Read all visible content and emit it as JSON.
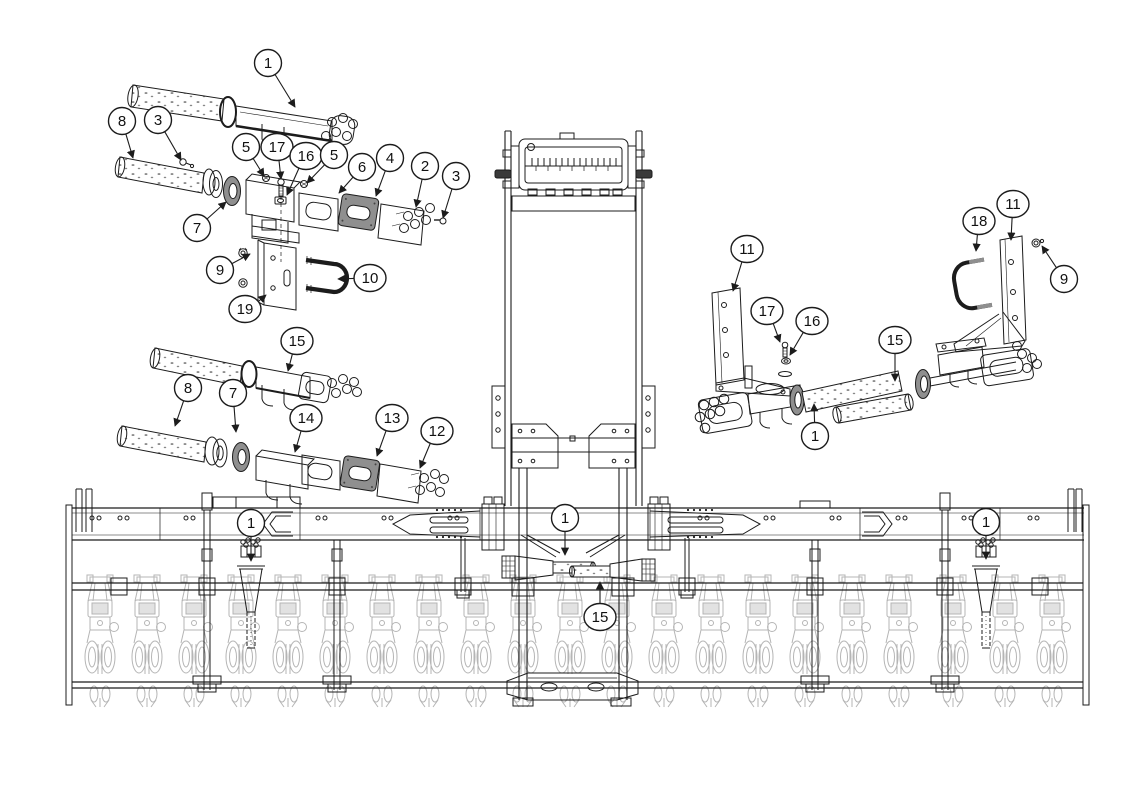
{
  "figure": {
    "type": "exploded-parts-diagram",
    "subject": "planter toolbar with center frame tower and exploded distribution-manifold mounting assemblies",
    "background": "#ffffff",
    "colors": {
      "line": "#1c1c1c",
      "light_line": "#b5b5b5",
      "shade": "#8f8f8f",
      "callout_fill": "#ffffff"
    },
    "callouts": [
      {
        "label": "1",
        "x": 268,
        "y": 63,
        "tx": 295,
        "ty": 107
      },
      {
        "label": "8",
        "x": 122,
        "y": 121,
        "tx": 133,
        "ty": 158
      },
      {
        "label": "3",
        "x": 158,
        "y": 120,
        "tx": 181,
        "ty": 160
      },
      {
        "label": "5",
        "x": 246,
        "y": 147,
        "tx": 264,
        "ty": 176
      },
      {
        "label": "17",
        "x": 277,
        "y": 147,
        "tx": 281,
        "ty": 179
      },
      {
        "label": "16",
        "x": 306,
        "y": 156,
        "tx": 287,
        "ty": 195
      },
      {
        "label": "5",
        "x": 334,
        "y": 155,
        "tx": 307,
        "ty": 183
      },
      {
        "label": "6",
        "x": 362,
        "y": 167,
        "tx": 339,
        "ty": 193
      },
      {
        "label": "4",
        "x": 390,
        "y": 158,
        "tx": 376,
        "ty": 196
      },
      {
        "label": "2",
        "x": 425,
        "y": 166,
        "tx": 416,
        "ty": 207
      },
      {
        "label": "3",
        "x": 456,
        "y": 176,
        "tx": 443,
        "ty": 218
      },
      {
        "label": "7",
        "x": 197,
        "y": 228,
        "tx": 226,
        "ty": 202
      },
      {
        "label": "9",
        "x": 220,
        "y": 270,
        "tx": 250,
        "ty": 254
      },
      {
        "label": "10",
        "x": 370,
        "y": 278,
        "tx": 338,
        "ty": 279
      },
      {
        "label": "19",
        "x": 245,
        "y": 309,
        "tx": 266,
        "ty": 295
      },
      {
        "label": "15",
        "x": 297,
        "y": 341,
        "tx": 288,
        "ty": 371
      },
      {
        "label": "8",
        "x": 188,
        "y": 388,
        "tx": 175,
        "ty": 426
      },
      {
        "label": "7",
        "x": 233,
        "y": 393,
        "tx": 236,
        "ty": 432
      },
      {
        "label": "14",
        "x": 306,
        "y": 418,
        "tx": 295,
        "ty": 452
      },
      {
        "label": "13",
        "x": 392,
        "y": 418,
        "tx": 377,
        "ty": 456
      },
      {
        "label": "12",
        "x": 437,
        "y": 431,
        "tx": 420,
        "ty": 468
      },
      {
        "label": "11",
        "x": 747,
        "y": 249,
        "tx": 733,
        "ty": 291
      },
      {
        "label": "17",
        "x": 767,
        "y": 311,
        "tx": 780,
        "ty": 342
      },
      {
        "label": "16",
        "x": 812,
        "y": 321,
        "tx": 790,
        "ty": 355
      },
      {
        "label": "18",
        "x": 979,
        "y": 221,
        "tx": 976,
        "ty": 251
      },
      {
        "label": "11",
        "x": 1013,
        "y": 204,
        "tx": 1011,
        "ty": 240
      },
      {
        "label": "9",
        "x": 1064,
        "y": 279,
        "tx": 1042,
        "ty": 246
      },
      {
        "label": "15",
        "x": 895,
        "y": 340,
        "tx": 895,
        "ty": 381
      },
      {
        "label": "1",
        "x": 815,
        "y": 436,
        "tx": 814,
        "ty": 404
      },
      {
        "label": "1",
        "x": 251,
        "y": 523,
        "tx": 251,
        "ty": 561
      },
      {
        "label": "1",
        "x": 565,
        "y": 518,
        "tx": 565,
        "ty": 555
      },
      {
        "label": "15",
        "x": 600,
        "y": 617,
        "tx": 600,
        "ty": 582
      },
      {
        "label": "1",
        "x": 986,
        "y": 522,
        "tx": 986,
        "ty": 559
      }
    ]
  }
}
